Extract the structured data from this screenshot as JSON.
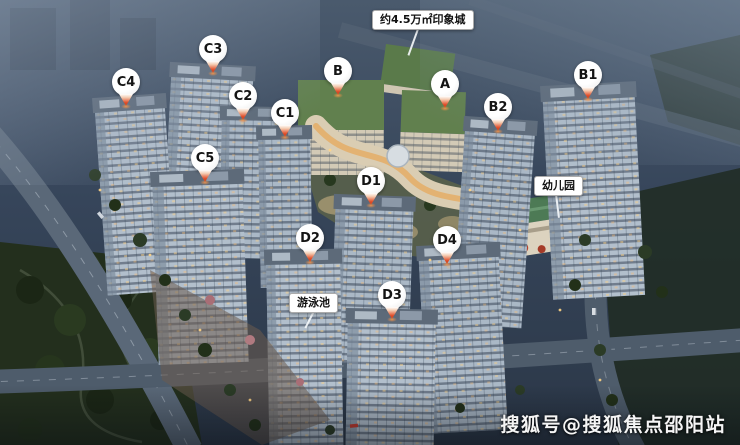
{
  "image": {
    "watermark": "搜狐号@搜狐焦点邵阳站",
    "annotations": {
      "mall": "约4.5万㎡印象城",
      "kindergarten": "幼儿园",
      "pool": "游泳池"
    },
    "pins": [
      {
        "label": "C4"
      },
      {
        "label": "C3"
      },
      {
        "label": "C2"
      },
      {
        "label": "C1"
      },
      {
        "label": "C5"
      },
      {
        "label": "B"
      },
      {
        "label": "A"
      },
      {
        "label": "B2"
      },
      {
        "label": "B1"
      },
      {
        "label": "D1"
      },
      {
        "label": "D2"
      },
      {
        "label": "D3"
      },
      {
        "label": "D4"
      }
    ],
    "colors": {
      "pin_tip_red": "#e2512c",
      "note_background": "#ffffff",
      "note_text": "#111111",
      "night_sky": "#36455a",
      "mall_roof_green": "#5e7d4f",
      "watermark_text": "#f5f5f5"
    }
  }
}
